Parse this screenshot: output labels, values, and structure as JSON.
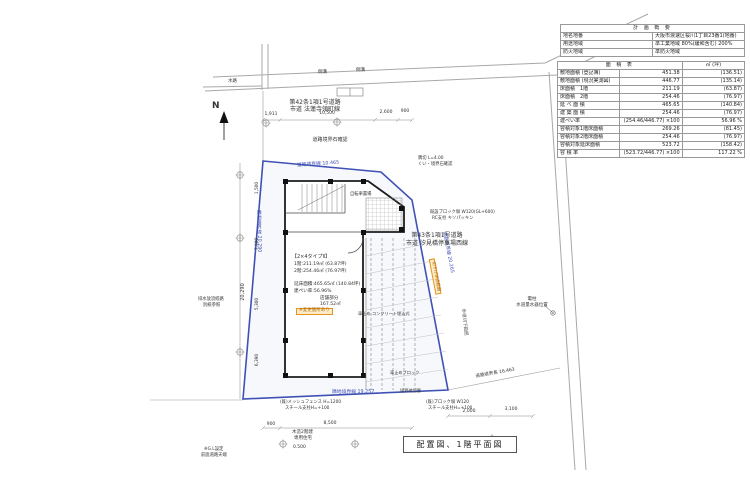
{
  "title_block": {
    "label": "配置図、1階平面図"
  },
  "north": {
    "label": "N"
  },
  "colors": {
    "boundary_blue": "#3f51b5",
    "highlight_orange": "#e8921a",
    "road_gray": "#a8a8a8",
    "building_black": "#1c1c1c"
  },
  "plan_summary_table": {
    "title": "計 画 概 要",
    "rows": [
      {
        "k": "地名地番",
        "v": "大阪市浪速区桜川1丁目23番1(地番)"
      },
      {
        "k": "用途地域",
        "v": "準工業地域 80%(緩和含む) 200%"
      },
      {
        "k": "防火地域",
        "v": "準防火地域"
      }
    ]
  },
  "area_table": {
    "title": "面 積 表",
    "unit_header": "㎡ (坪)",
    "rows": [
      [
        "敷地面積 (登記簿)",
        "451.38",
        "(136.51)"
      ],
      [
        "敷地面積 (現況実測図)",
        "446.77",
        "(135.14)"
      ],
      [
        "床面積　1階",
        "211.19",
        "(63.87)"
      ],
      [
        "床面積　2階",
        "254.46",
        "(76.97)"
      ],
      [
        "延 べ 面 積",
        "465.65",
        "(140.84)"
      ],
      [
        "建 築 面 積",
        "254.46",
        "(76.97)"
      ],
      [
        "建ぺい率",
        "(254.46/446.77) ×100",
        "56.96 %"
      ],
      [
        "容積対象1階床面積",
        "269.26",
        "(81.45)"
      ],
      [
        "容積対象2階床面積",
        "254.46",
        "(76.97)"
      ],
      [
        "容積対象延床面積",
        "523.72",
        "(158.42)"
      ],
      [
        "容 積 率",
        "(523.72/446.77) ×100",
        "117.22 %"
      ]
    ]
  },
  "labels": [
    {
      "text": "N",
      "x": 212,
      "y": 102,
      "size": 9,
      "bold": true,
      "name": "north-label"
    },
    {
      "text": "第42条1項1号道路",
      "x": 315,
      "y": 100,
      "size": 6,
      "align": "center",
      "name": "road-label-north"
    },
    {
      "text": "市道 法蓮寺領町線",
      "x": 315,
      "y": 107,
      "size": 6,
      "align": "center",
      "name": "road-label-north-2"
    },
    {
      "text": "道路境界石確認",
      "x": 330,
      "y": 138,
      "size": 5,
      "align": "center"
    },
    {
      "text": "水路",
      "x": 228,
      "y": 80,
      "size": 4.5
    },
    {
      "text": "側溝",
      "x": 318,
      "y": 71,
      "size": 4.5
    },
    {
      "text": "側溝",
      "x": 356,
      "y": 69,
      "size": 4.5
    },
    {
      "text": "1,911",
      "x": 271,
      "y": 113,
      "size": 4.5,
      "align": "center"
    },
    {
      "text": "10,500",
      "x": 327,
      "y": 112,
      "size": 4.5,
      "align": "center"
    },
    {
      "text": "2,600",
      "x": 386,
      "y": 111,
      "size": 4.5,
      "align": "center"
    },
    {
      "text": "900",
      "x": 405,
      "y": 110,
      "size": 4.5,
      "align": "center"
    },
    {
      "text": "道路境界線 10.465",
      "x": 318,
      "y": 163,
      "size": 4.8,
      "align": "center",
      "rotate": -4,
      "cls": "blue",
      "name": "boundary-label-north"
    },
    {
      "text": "隣地境界線 20.290",
      "x": 255,
      "y": 210,
      "size": 4.8,
      "vert": true,
      "cls": "blue",
      "name": "boundary-label-west"
    },
    {
      "text": "道路境界線 20.265",
      "x": 428,
      "y": 252,
      "size": 4.8,
      "rotate": 79,
      "cls": "blue",
      "name": "boundary-label-east"
    },
    {
      "text": "隣地境界線 19.257",
      "x": 332,
      "y": 391,
      "size": 4.8,
      "cls": "blue",
      "name": "boundary-label-south"
    },
    {
      "text": "道路境界長 16.463",
      "x": 495,
      "y": 372,
      "size": 4.5,
      "align": "center",
      "rotate": -10
    },
    {
      "text": "第43条1項1号道路",
      "x": 437,
      "y": 233,
      "size": 6,
      "align": "center",
      "name": "road-label-east"
    },
    {
      "text": "市道 汐見橋停車場西線",
      "x": 437,
      "y": 241,
      "size": 6,
      "align": "center",
      "name": "road-label-east-2"
    },
    {
      "text": "電柱",
      "x": 532,
      "y": 298,
      "size": 4.5,
      "align": "center"
    },
    {
      "text": "水道量水器位置",
      "x": 532,
      "y": 304,
      "size": 4.5,
      "align": "center"
    },
    {
      "text": "歩道切下範囲",
      "x": 452,
      "y": 322,
      "size": 4.5,
      "rotate": 84,
      "color": "#555"
    },
    {
      "text": "切下げ申請範囲",
      "x": 420,
      "y": 276,
      "size": 4.3,
      "rotate": 79,
      "cls": "orange",
      "name": "highlight-label-boundary"
    },
    {
      "text": "隅切 L=4.00",
      "x": 418,
      "y": 157,
      "size": 4.3
    },
    {
      "text": "くい・境界石確認",
      "x": 418,
      "y": 163,
      "size": 4.3
    },
    {
      "text": "既設ブロック塀 W120(GL+600)",
      "x": 430,
      "y": 211,
      "size": 4.3
    },
    {
      "text": "RC支柱 キソパッキン",
      "x": 432,
      "y": 217,
      "size": 4.3
    },
    {
      "text": "自転車置場",
      "x": 350,
      "y": 193,
      "size": 4.3
    },
    {
      "text": "【2×4タイプⅡ】",
      "x": 292,
      "y": 255,
      "size": 5,
      "name": "building-spec-title"
    },
    {
      "text": "1階:211.19㎡ (63.87坪)",
      "x": 294,
      "y": 263,
      "size": 4.6
    },
    {
      "text": "2階:254.46㎡ (76.97坪)",
      "x": 294,
      "y": 270,
      "size": 4.6
    },
    {
      "text": "延床面積:465.65㎡ (140.84坪)",
      "x": 294,
      "y": 283,
      "size": 4.6
    },
    {
      "text": "建ぺい率:56.96%",
      "x": 294,
      "y": 290,
      "size": 4.6
    },
    {
      "text": "店舗部分",
      "x": 320,
      "y": 297,
      "size": 4.6
    },
    {
      "text": "167.52㎡",
      "x": 320,
      "y": 303,
      "size": 4.6
    },
    {
      "text": "※変更箇所あり",
      "x": 296,
      "y": 308,
      "size": 4.5,
      "cls": "orange",
      "name": "highlight-label-building"
    },
    {
      "text": "車止め コンクリート埋込式",
      "x": 358,
      "y": 312,
      "size": 4.2
    },
    {
      "text": "車止めブロック",
      "x": 390,
      "y": 371,
      "size": 4.2
    },
    {
      "text": "境界確認要",
      "x": 400,
      "y": 389,
      "size": 4.2
    },
    {
      "text": "(既)メッシュフェンス H=1200",
      "x": 280,
      "y": 401,
      "size": 4.3
    },
    {
      "text": "スチール支柱H=+100",
      "x": 285,
      "y": 407,
      "size": 4.3
    },
    {
      "text": "(既)ブロック塀 W120",
      "x": 426,
      "y": 401,
      "size": 4.3
    },
    {
      "text": "スチール支柱H=+100",
      "x": 428,
      "y": 407,
      "size": 4.3
    },
    {
      "text": "900",
      "x": 271,
      "y": 423,
      "size": 4.5,
      "align": "center"
    },
    {
      "text": "8,500",
      "x": 330,
      "y": 422,
      "size": 4.5,
      "align": "center"
    },
    {
      "text": "2,000",
      "x": 469,
      "y": 410,
      "size": 4.5,
      "align": "center"
    },
    {
      "text": "3,100",
      "x": 511,
      "y": 408,
      "size": 4.5,
      "align": "center"
    },
    {
      "text": "木造2階建",
      "x": 292,
      "y": 431,
      "size": 4.5
    },
    {
      "text": "専用住宅",
      "x": 294,
      "y": 437,
      "size": 4.5
    },
    {
      "text": "※G.L設定",
      "x": 204,
      "y": 448,
      "size": 4.3
    },
    {
      "text": "前面道路天端",
      "x": 201,
      "y": 454,
      "size": 4.3
    },
    {
      "text": "0.500",
      "x": 293,
      "y": 446,
      "size": 4.5
    },
    {
      "text": "排水放流経路",
      "x": 198,
      "y": 298,
      "size": 4.3
    },
    {
      "text": "別紙参照",
      "x": 203,
      "y": 304,
      "size": 4.3
    },
    {
      "text": "1,500",
      "x": 250,
      "y": 188,
      "size": 4.3,
      "rotate": -90
    },
    {
      "text": "7,100",
      "x": 250,
      "y": 244,
      "size": 4.3,
      "rotate": -90
    },
    {
      "text": "5,300",
      "x": 250,
      "y": 304,
      "size": 4.3,
      "rotate": -90
    },
    {
      "text": "6,390",
      "x": 250,
      "y": 360,
      "size": 4.3,
      "rotate": -90
    },
    {
      "text": "20,290",
      "x": 232,
      "y": 292,
      "size": 5,
      "rotate": -90,
      "name": "overall-dimension-west"
    }
  ]
}
